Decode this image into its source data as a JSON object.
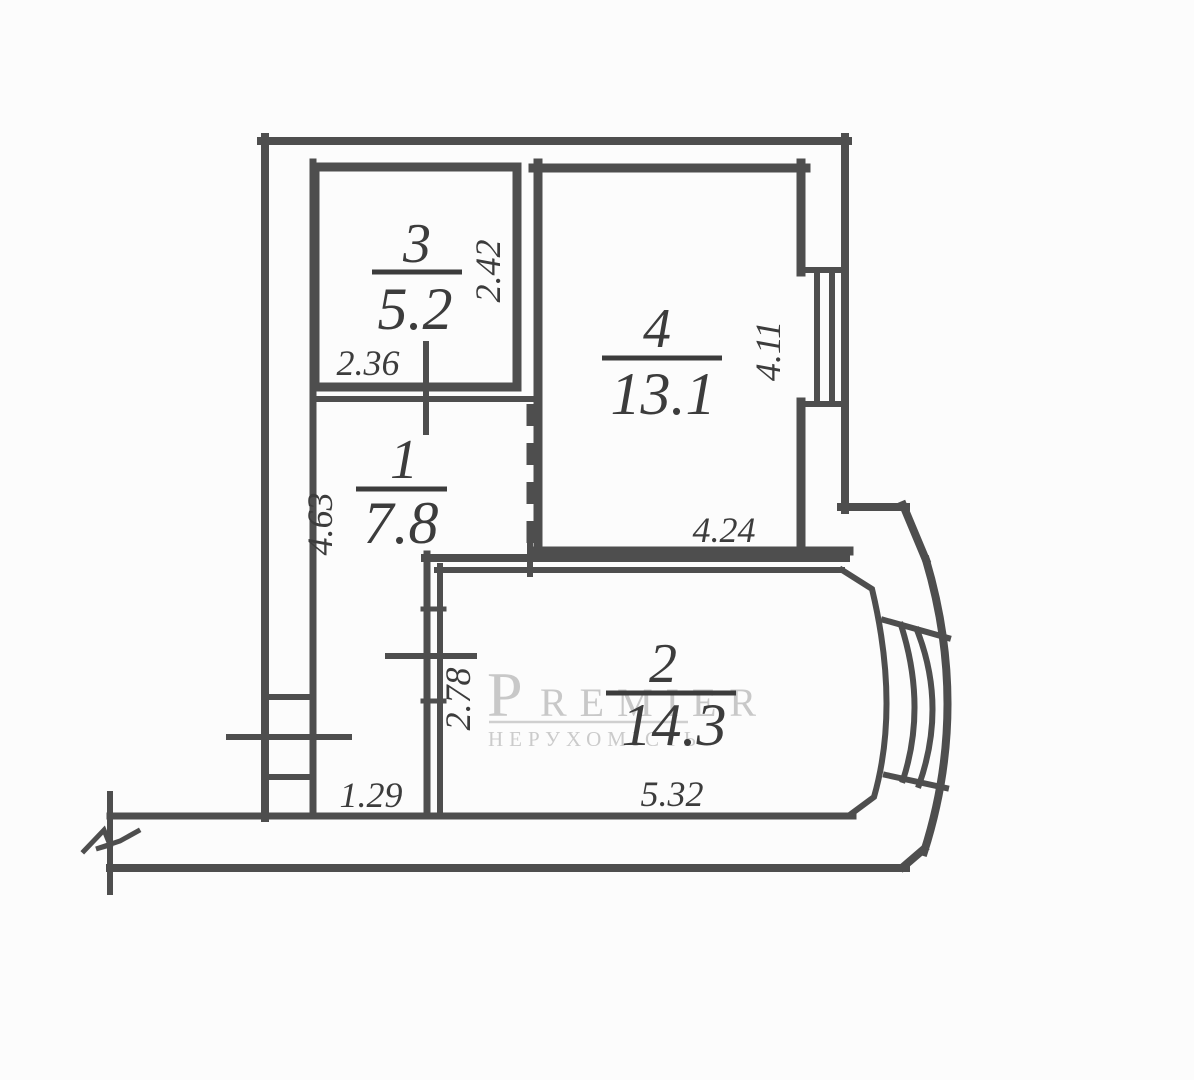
{
  "title": "apartment-floor-plan",
  "watermark": {
    "initial": "P",
    "rest": "REMIER",
    "subtitle": "НЕРУХОМІСТЬ",
    "color": "#c8c8c8"
  },
  "rooms": [
    {
      "number": "3",
      "area": "5.2"
    },
    {
      "number": "4",
      "area": "13.1"
    },
    {
      "number": "1",
      "area": "7.8"
    },
    {
      "number": "2",
      "area": "14.3"
    }
  ],
  "dimensions": {
    "room3_width": "2.36",
    "room3_depth": "2.42",
    "room4_width": "4.24",
    "room4_depth": "4.11",
    "room1_depth": "4.63",
    "hall_bottom": "1.29",
    "room2_width": "5.32",
    "room2_depth": "2.78"
  },
  "colors": {
    "wall": "#4e4e4e",
    "label": "#3c3c3c",
    "background": "#fcfcfc"
  }
}
